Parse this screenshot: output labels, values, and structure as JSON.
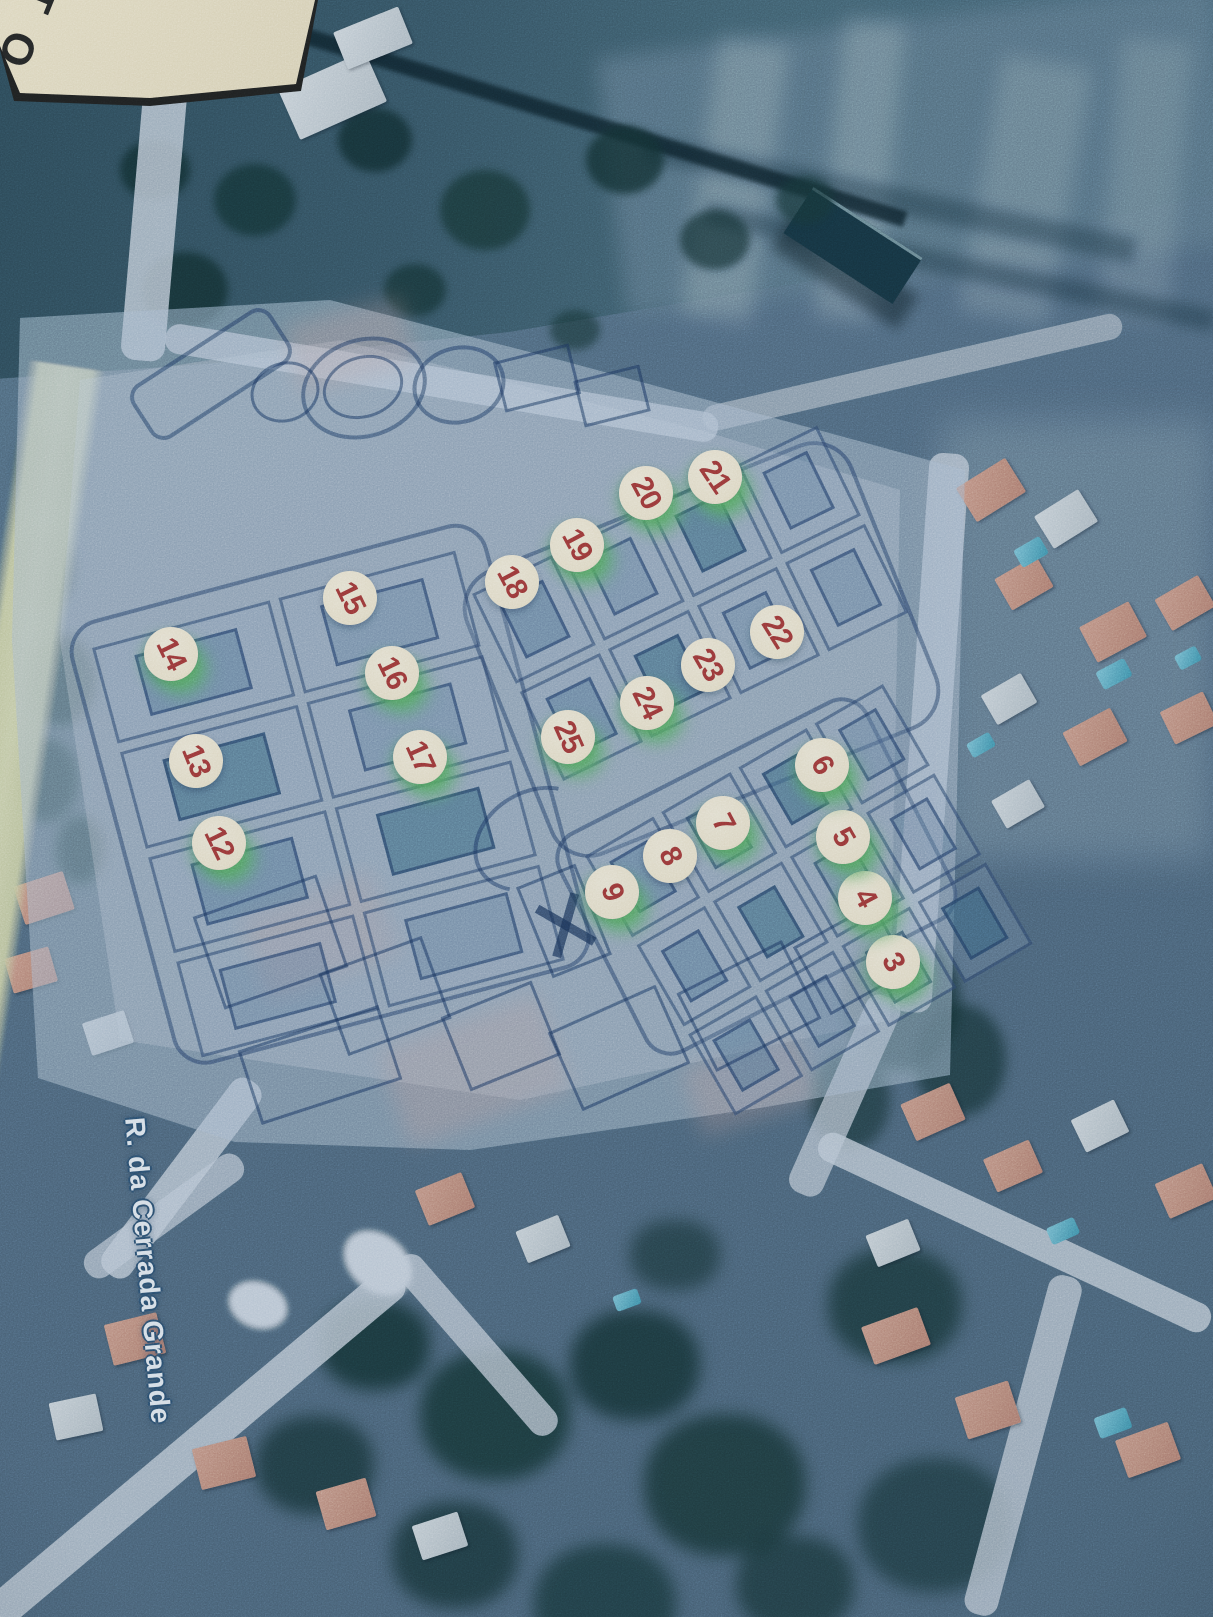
{
  "corner_note": {
    "text": "TO"
  },
  "street": {
    "name": "R. da Cerrada Grande"
  },
  "colors": {
    "marker_fill": "#F3E9CE",
    "marker_number": "#A23531",
    "marker_glow": "#63B868",
    "street_label": "#ECF2F7",
    "road_yellow": "#DCDEB0"
  },
  "markers": [
    {
      "label": "3",
      "x": 893,
      "y": 962,
      "rot": 60,
      "glow": true
    },
    {
      "label": "4",
      "x": 865,
      "y": 898,
      "rot": 62,
      "glow": true
    },
    {
      "label": "5",
      "x": 843,
      "y": 837,
      "rot": 60,
      "glow": true
    },
    {
      "label": "6",
      "x": 822,
      "y": 765,
      "rot": 60,
      "glow": true
    },
    {
      "label": "7",
      "x": 723,
      "y": 823,
      "rot": 62,
      "glow": true
    },
    {
      "label": "8",
      "x": 670,
      "y": 856,
      "rot": 64,
      "glow": false
    },
    {
      "label": "9",
      "x": 612,
      "y": 892,
      "rot": 70,
      "glow": true
    },
    {
      "label": "12",
      "x": 219,
      "y": 843,
      "rot": 64,
      "glow": true
    },
    {
      "label": "13",
      "x": 196,
      "y": 761,
      "rot": 68,
      "glow": false
    },
    {
      "label": "14",
      "x": 171,
      "y": 654,
      "rot": 64,
      "glow": true
    },
    {
      "label": "15",
      "x": 350,
      "y": 598,
      "rot": 64,
      "glow": false
    },
    {
      "label": "16",
      "x": 392,
      "y": 673,
      "rot": 64,
      "glow": true
    },
    {
      "label": "17",
      "x": 420,
      "y": 757,
      "rot": 66,
      "glow": true
    },
    {
      "label": "18",
      "x": 512,
      "y": 582,
      "rot": 62,
      "glow": false
    },
    {
      "label": "19",
      "x": 577,
      "y": 545,
      "rot": 62,
      "glow": true
    },
    {
      "label": "20",
      "x": 646,
      "y": 493,
      "rot": 62,
      "glow": true
    },
    {
      "label": "21",
      "x": 715,
      "y": 477,
      "rot": 56,
      "glow": true
    },
    {
      "label": "22",
      "x": 777,
      "y": 632,
      "rot": 58,
      "glow": false
    },
    {
      "label": "23",
      "x": 708,
      "y": 665,
      "rot": 60,
      "glow": false
    },
    {
      "label": "24",
      "x": 647,
      "y": 703,
      "rot": 64,
      "glow": true
    },
    {
      "label": "25",
      "x": 568,
      "y": 737,
      "rot": 66,
      "glow": true
    }
  ]
}
